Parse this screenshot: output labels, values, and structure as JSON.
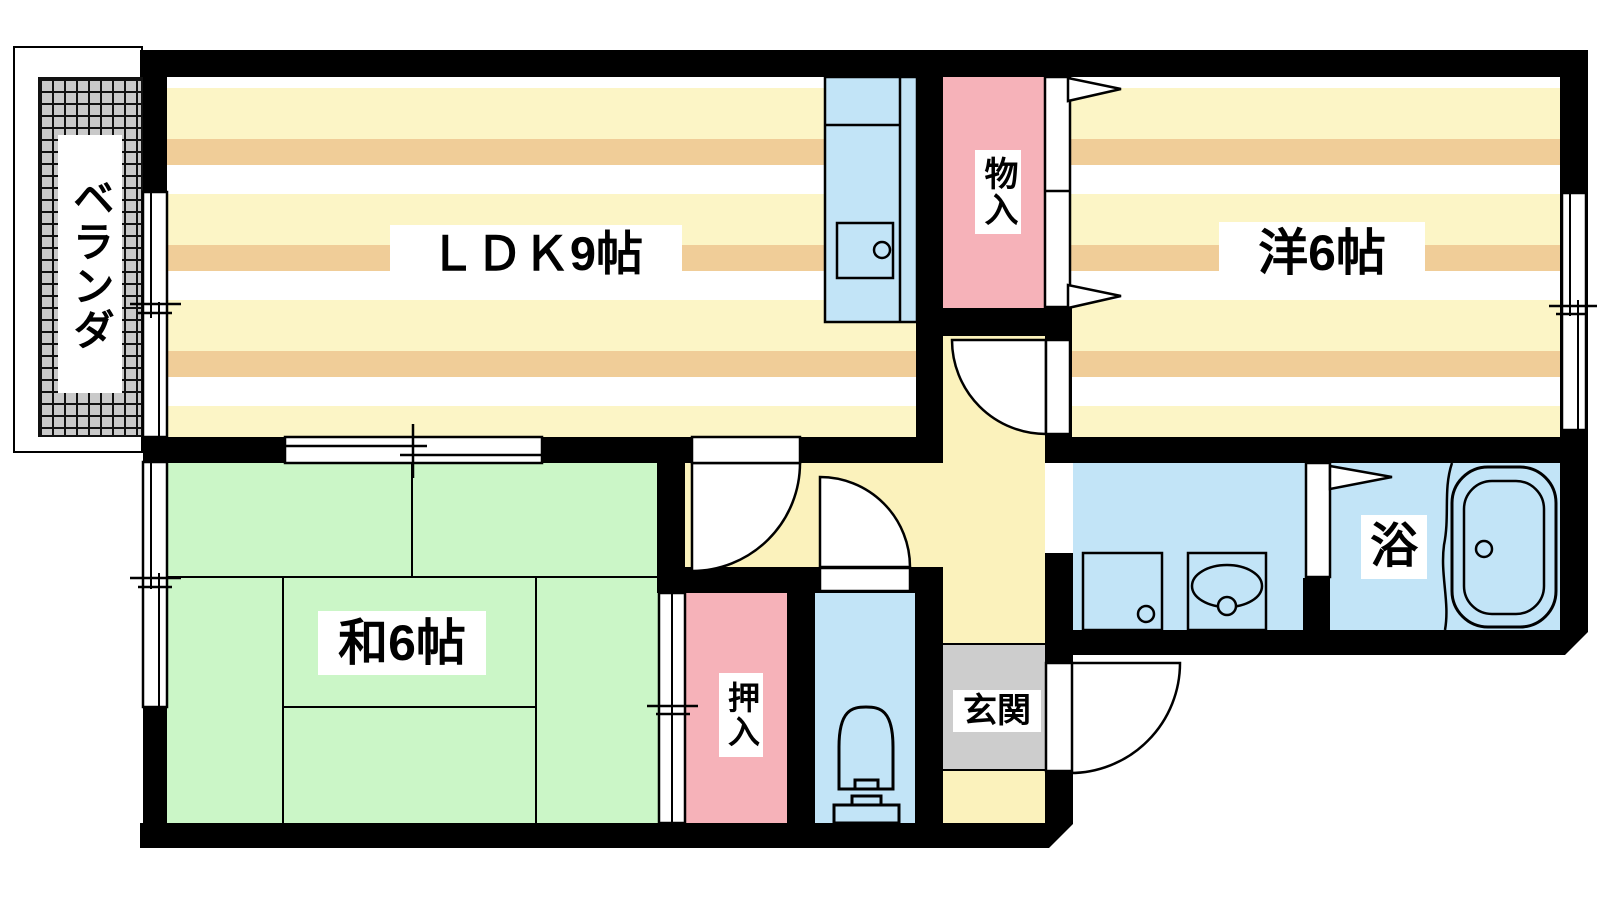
{
  "plan_title": "apartment-floor-plan",
  "rooms": {
    "veranda": {
      "label": "ベランダ"
    },
    "ldk": {
      "label": "ＬＤＫ9帖"
    },
    "storage": {
      "label": "物入"
    },
    "western_room": {
      "label": "洋6帖"
    },
    "japanese_room": {
      "label": "和6帖"
    },
    "closet": {
      "label": "押入"
    },
    "entrance": {
      "label": "玄関"
    },
    "bath": {
      "label": "浴"
    }
  },
  "fixtures": {
    "kitchen": "kitchen-counter-with-sink",
    "toilet": "toilet",
    "washroom": [
      "washing-machine-pan",
      "washbasin"
    ],
    "bath": "bathtub"
  },
  "colors": {
    "wall": "#000000",
    "stripe_yellow": "#fcf5c6",
    "stripe_tan": "#f0cd98",
    "stripe_white": "#ffffff",
    "hallway_cream": "#fbf2bc",
    "closet_pink": "#f6b2b9",
    "water_blue": "#c2e4f7",
    "tatami_green": "#cbf6c7",
    "entrance_gray": "#cdcdcd",
    "veranda_gray": "#c9c9c9"
  }
}
